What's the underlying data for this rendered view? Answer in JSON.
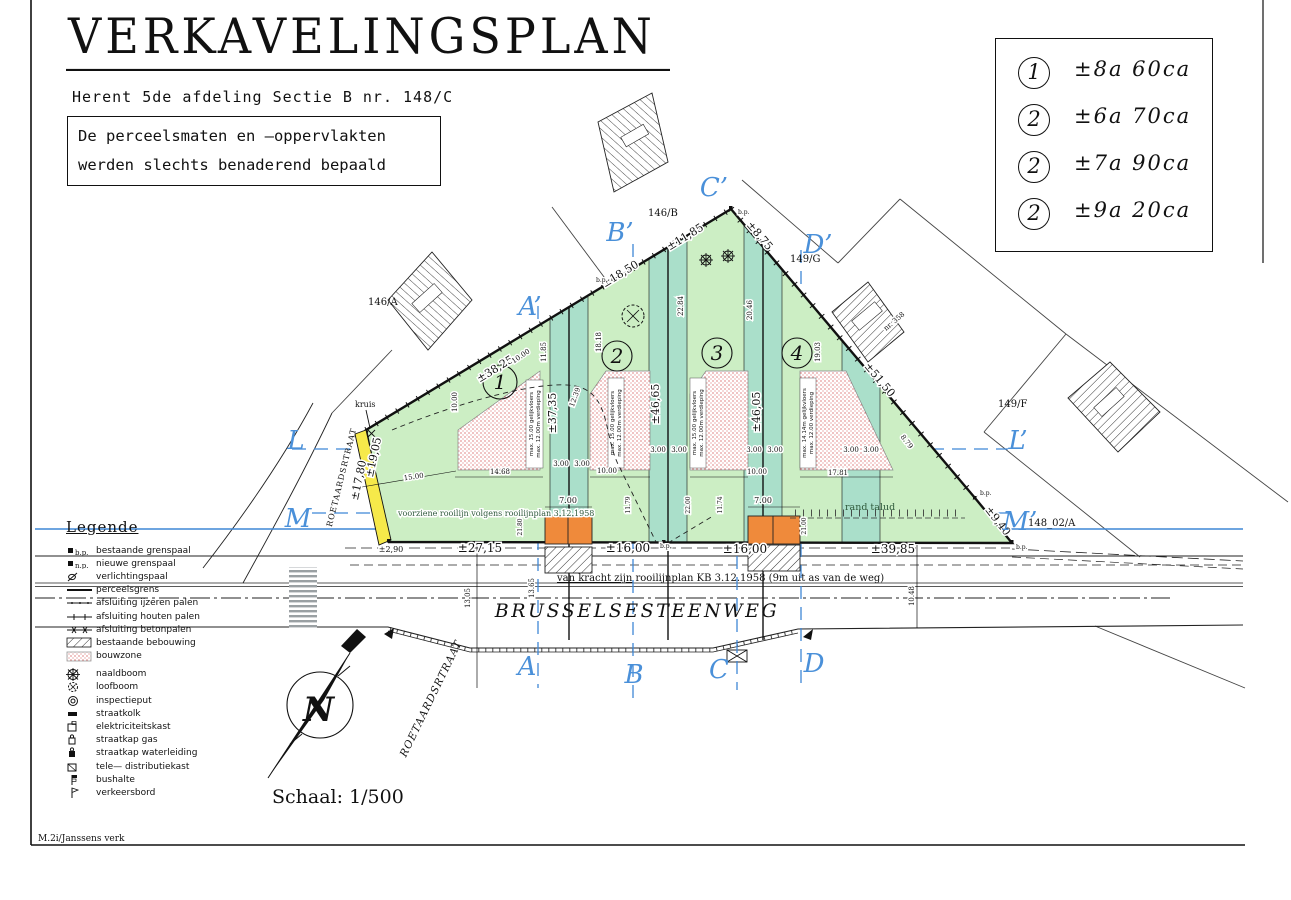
{
  "title": {
    "main": "VERKAVELINGSPLAN",
    "subtitle": "Herent 5de afdeling Sectie B nr. 148/C",
    "note1": "De perceelsmaten en –oppervlakten",
    "note2": "werden slechts benaderend bepaald"
  },
  "areas": {
    "rows": [
      {
        "n": "1",
        "v": "±8a 60ca"
      },
      {
        "n": "2",
        "v": "±6a 70ca"
      },
      {
        "n": "2",
        "v": "±7a 90ca"
      },
      {
        "n": "2",
        "v": "±9a 20ca"
      }
    ]
  },
  "legend": {
    "title": "Legende",
    "bp": "b.p.",
    "np": "n.p.",
    "items": [
      {
        "label": "bestaande grenspaal"
      },
      {
        "label": "nieuwe grenspaal"
      },
      {
        "label": "verlichtingspaal"
      },
      {
        "label": "perceelsgrens"
      },
      {
        "label": "afsluiting ijzeren palen"
      },
      {
        "label": "afsluiting houten palen"
      },
      {
        "label": "afsluiting betonpalen"
      },
      {
        "label": "bestaande bebouwing"
      },
      {
        "label": "bouwzone"
      },
      {
        "label": "naaldboom"
      },
      {
        "label": "loofboom"
      },
      {
        "label": "inspectieput"
      },
      {
        "label": "straatkolk"
      },
      {
        "label": "elektriciteitskast"
      },
      {
        "label": "straatkap gas"
      },
      {
        "label": "straatkap waterleiding"
      },
      {
        "label": "tele— distributiekast"
      },
      {
        "label": "bushalte"
      },
      {
        "label": "verkeersbord"
      }
    ]
  },
  "plan": {
    "lots": [
      "1",
      "2",
      "3",
      "4"
    ],
    "parcels": {
      "p146a": "146/A",
      "p146b": "146/B",
      "p149g": "149/G",
      "p149f": "149/F",
      "p148": "148_02/A",
      "nr358": "nr. 358"
    },
    "sections": {
      "a": "A",
      "b": "B",
      "c": "C",
      "d": "D",
      "ap": "A’",
      "bp": "B’",
      "cp": "C’",
      "dp": "D’",
      "l": "L",
      "lp": "L’",
      "m": "M",
      "mp": "M’"
    },
    "edges": {
      "e1": "±38,25",
      "e2": "±18,50",
      "e3": "±11,85",
      "e4": "±8,75",
      "e5": "±51,50",
      "e6": "±9,40",
      "e7": "±19,05",
      "e8": "±17,80"
    },
    "bottom": {
      "d1": "±2,90",
      "d2": "±27,15",
      "d3": "±16,00",
      "d4": "±16,00",
      "d5": "±39,85"
    },
    "vert": {
      "v1": "±37,35",
      "v2": "±46,65",
      "v3": "±46,05"
    },
    "dims": [
      "3.00",
      "3.00",
      "3.00",
      "3.00",
      "3.00",
      "3.00",
      "3.00",
      "3.00",
      "14.68",
      "10.00",
      "10.00",
      "17.81",
      "15.00",
      "7.00",
      "7.00",
      "11.79",
      "22.00",
      "11.74",
      "21.80",
      "21.00",
      "22.84",
      "20.46",
      "19.03",
      "10.00",
      "10.00",
      "11.85",
      "18.18",
      "12.39",
      "8.79",
      "13.05",
      "13.65",
      "10.48"
    ],
    "bp_label": "b.p.",
    "kruis": "kruis",
    "rand_talud": "rand talud",
    "rooilijn_voorzien": "voorziene rooilijn volgens rooilijnplan 3.12.1958",
    "rooilijn_kb1": "van kracht zijn",
    "rooilijn_kb2": " rooilijnplan KB 3.12.1958 (9m uit as van de weg)",
    "zone_line1": "max. 15.00 gelijkvloers",
    "zone_line2": "max. 12.00m verdieping",
    "zone4_line1": "max. 14.14m gelijkvloers",
    "zone4_line2": "max. 12.00 verdieping",
    "streets": {
      "main": "BRUSSELSESTEENWEG",
      "side": "ROETAARDSRTRAAT"
    }
  },
  "compass": {
    "n": "N"
  },
  "scale": {
    "label": "Schaal: 1/500"
  },
  "footer": {
    "ref": "M.2i/Janssens verk"
  },
  "colors": {
    "light_green": "#cceec4",
    "teal": "#aadfca",
    "yellow": "#f6e94a",
    "orange": "#ef8a3b",
    "blue": "#4a90d9",
    "bouwzone_red": "#cc3333"
  }
}
